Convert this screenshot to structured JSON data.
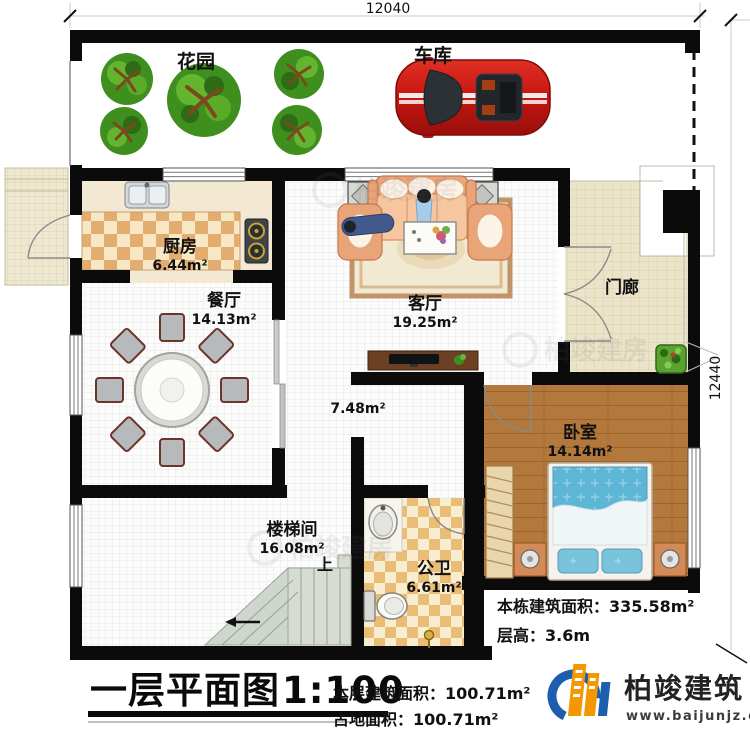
{
  "dimensions": {
    "width": "12040",
    "height": "12440"
  },
  "watermark": "柏竣建房",
  "rooms": {
    "garden": {
      "label": "花园"
    },
    "garage": {
      "label": "车库"
    },
    "kitchen": {
      "label": "厨房",
      "area": "6.44m²"
    },
    "dining": {
      "label": "餐厅",
      "area": "14.13m²"
    },
    "living": {
      "label": "客厅",
      "area": "19.25m²"
    },
    "porch": {
      "label": "门廊"
    },
    "hall": {
      "area": "7.48m²"
    },
    "bedroom": {
      "label": "卧室",
      "area": "14.14m²"
    },
    "stair": {
      "label": "楼梯间",
      "area": "16.08m²",
      "up_label": "上"
    },
    "bath": {
      "label": "公卫",
      "area": "6.61m²"
    }
  },
  "title": {
    "text": "一层平面图",
    "scale": "1:100"
  },
  "stats": {
    "floor_area": "本层建筑面积：100.71m²",
    "land_area": "占地面积：100.71m²",
    "total_area": "本栋建筑面积：335.58m²",
    "floor_height": "层高：3.6m"
  },
  "logo": {
    "name": "柏竣建筑",
    "url": "www.baijunjz.com"
  }
}
